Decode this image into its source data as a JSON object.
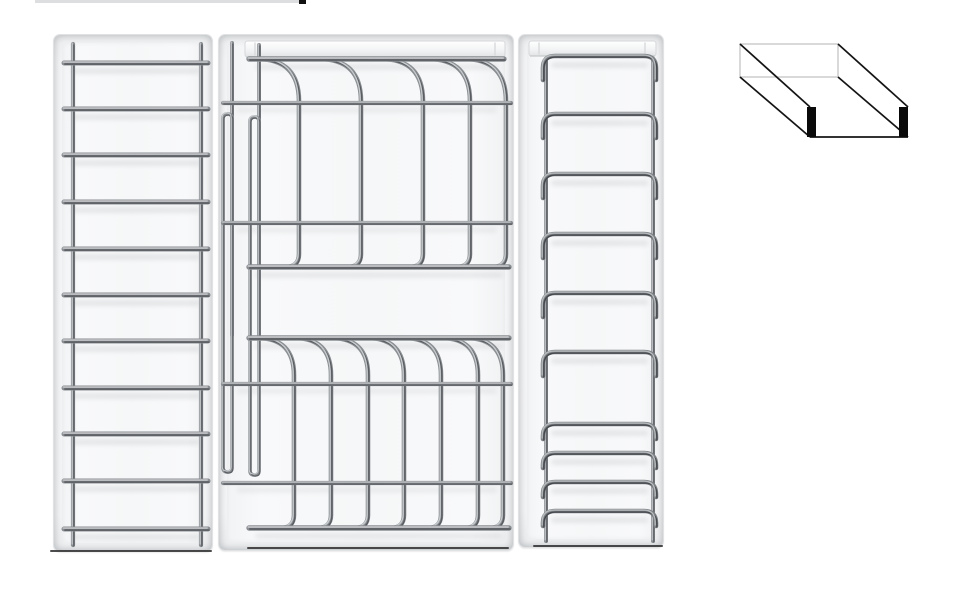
{
  "canvas": {
    "width": 973,
    "height": 600,
    "background": "#ffffff"
  },
  "palette": {
    "page_bg": "#ffffff",
    "tray_face": "#f4f5f6",
    "tray_edge": "#e0e2e4",
    "wire": {
      "base": "#8a8e92",
      "dark": "#5a5e62",
      "light": "#c9ccce"
    },
    "arch_wire": {
      "base": "#7e8286",
      "dark": "#45494d",
      "light": "#b8bbbd"
    },
    "rail_fill_top": "#ffffff",
    "rail_fill_bottom": "#e1e3e5",
    "rail_stroke": "#d5d7d9",
    "shadow_band": "#46505a",
    "base_shadow": "#2e2e2e",
    "diagram_line": "#141414",
    "diagram_light": "#c9c9c9",
    "diagram_tab": "#0a0a0a"
  },
  "cropped_item": {
    "line": {
      "x": 35,
      "y": 0,
      "width": 266,
      "height": 3,
      "color": "#dcdee0"
    },
    "tick": {
      "x": 299,
      "y": 0,
      "width": 7,
      "height": 4,
      "color": "#111111"
    }
  },
  "racks": {
    "ladder": {
      "label": "ladder-bar rack",
      "x": 53,
      "y": 34,
      "width": 160,
      "height": 518,
      "rails_x": [
        19,
        147
      ],
      "rail_top": 9,
      "rail_bottom": 510,
      "rail_width": 4.2,
      "bars_y": [
        28,
        74,
        120,
        167,
        214,
        260,
        306,
        353,
        399,
        446,
        494
      ],
      "bar_x1": 10,
      "bar_x2": 154,
      "bar_width": 5
    },
    "plate": {
      "label": "plate-divider rack",
      "x": 218,
      "y": 34,
      "width": 296,
      "height": 517,
      "top_rail": {
        "x": 26,
        "y": 6,
        "width": 260,
        "height": 16,
        "notches": [
          36,
          276
        ]
      },
      "left_uprights": [
        {
          "x": 13,
          "y1": 8,
          "y2": 300
        },
        {
          "x": 40,
          "y1": 10,
          "y2": 300
        }
      ],
      "left_loops": [
        {
          "x": 4,
          "y1": 79,
          "y2": 437,
          "w": 9
        },
        {
          "x": 31,
          "y1": 82,
          "y2": 440,
          "w": 9
        }
      ],
      "cross_wires_y": [
        68,
        188,
        349,
        448
      ],
      "cross_x1": 4,
      "cross_x2": 292,
      "cross_width": 4.2,
      "sections": [
        {
          "attach_y": 24,
          "bar_y": 232,
          "verticals_x": [
            80,
            142,
            204,
            251,
            287
          ],
          "arc_r": 42,
          "foot_r": 14
        },
        {
          "attach_y": 303,
          "bar_y": 493,
          "verticals_x": [
            75,
            112,
            149,
            185,
            222,
            259,
            284
          ],
          "arc_r": 37,
          "foot_r": 14
        }
      ],
      "bars": [
        {
          "y": 24,
          "x1": 30,
          "x2": 285
        },
        {
          "y": 232,
          "x1": 30,
          "x2": 290
        },
        {
          "y": 303,
          "x1": 30,
          "x2": 290
        },
        {
          "y": 493,
          "x1": 30,
          "x2": 290
        }
      ],
      "bar_width": 5.4,
      "wire_width": 4.6
    },
    "arch": {
      "label": "arch-hoop rack",
      "x": 518,
      "y": 34,
      "width": 146,
      "height": 514,
      "top_rail": {
        "x": 10,
        "y": 6,
        "width": 127,
        "height": 15,
        "notches": [
          20,
          126
        ]
      },
      "rails_x": [
        27,
        134
      ],
      "rail_top": 24,
      "rail_bottom": 506,
      "rail_width": 4,
      "arch_x1": 24,
      "arch_x2": 137,
      "corner_r": 12,
      "tall_arches_y": [
        21,
        79,
        139,
        199,
        258,
        317
      ],
      "tall_leg": 24,
      "short_arches_y": [
        389,
        418,
        447,
        476
      ],
      "short_leg": 15,
      "wire_width": 4.6
    }
  },
  "base_shadows": [
    {
      "x": 50,
      "y": 550,
      "width": 162
    },
    {
      "x": 247,
      "y": 547,
      "width": 262
    },
    {
      "x": 533,
      "y": 545,
      "width": 130
    }
  ],
  "orientation_diagram": {
    "x": 735,
    "y": 40,
    "width": 180,
    "height": 105,
    "back_rect": {
      "x": 5,
      "y": 4,
      "width": 98,
      "height": 33
    },
    "edges": [
      [
        5,
        4,
        75,
        67
      ],
      [
        103,
        4,
        173,
        67
      ],
      [
        5,
        37,
        75,
        97
      ],
      [
        103,
        37,
        173,
        97
      ],
      [
        75,
        97,
        173,
        97
      ]
    ],
    "front_tabs": [
      {
        "x": 72,
        "y": 67,
        "width": 9,
        "height": 30
      },
      {
        "x": 164,
        "y": 67,
        "width": 9,
        "height": 30
      }
    ]
  }
}
